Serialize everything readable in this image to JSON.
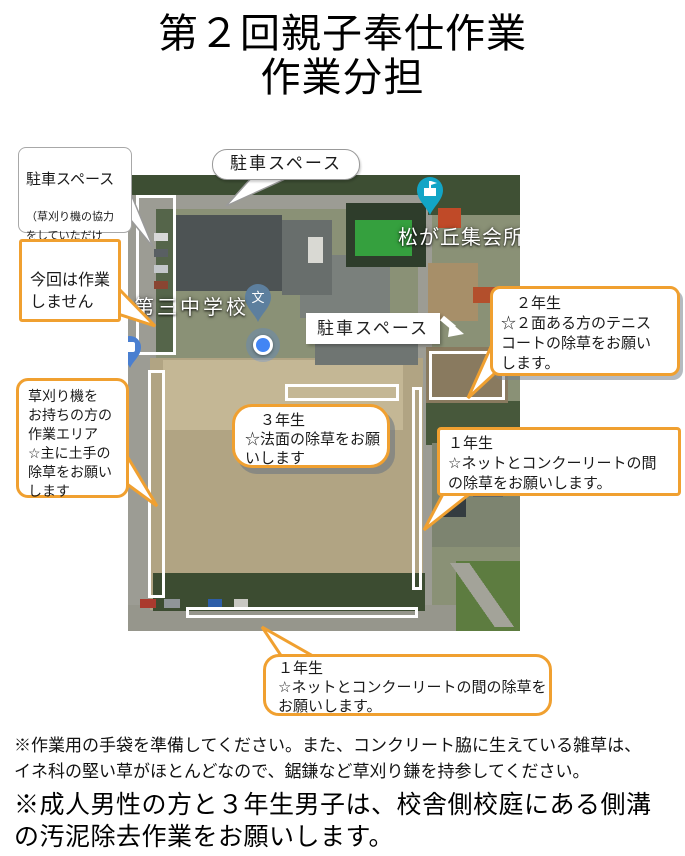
{
  "accent_color": "#f0a030",
  "title": {
    "line1": "第２回親子奉仕作業",
    "line2": "作業分担"
  },
  "map": {
    "school_label": "第三中学校",
    "hall_label": "松が丘集会所",
    "school_pin_glyph": "文",
    "parking_label": "駐車スペース"
  },
  "callouts": {
    "parking_left_title": "駐車スペース",
    "parking_left_note": "（草刈り機の協力\nをしていただけ\nる方優先）",
    "no_work": "今回は作業\nしません",
    "parking_top": "駐車スペース",
    "grade2": "　２年生\n☆２面ある方のテニス\nコートの除草をお願い\nします。",
    "grade3": "　３年生\n☆法面の除草をお願\nいします",
    "grade1_right": "１年生\n☆ネットとコンクーリートの間\nの除草をお願いします。",
    "mower": "草刈り機を\nお持ちの方の\n作業エリア\n☆主に土手の\n除草をお願い\nします",
    "grade1_bottom": "１年生\n☆ネットとコンクーリートの間の除草を\nお願いします。"
  },
  "notes": {
    "small": "※作業用の手袋を準備してください。また、コンクリート脇に生えている雑草は、\nイネ科の堅い草がほとんどなので、鋸鎌など草刈り鎌を持参してください。",
    "large": "※成人男性の方と３年生男子は、校舎側校庭にある側溝\nの汚泥除去作業をお願いします。"
  }
}
